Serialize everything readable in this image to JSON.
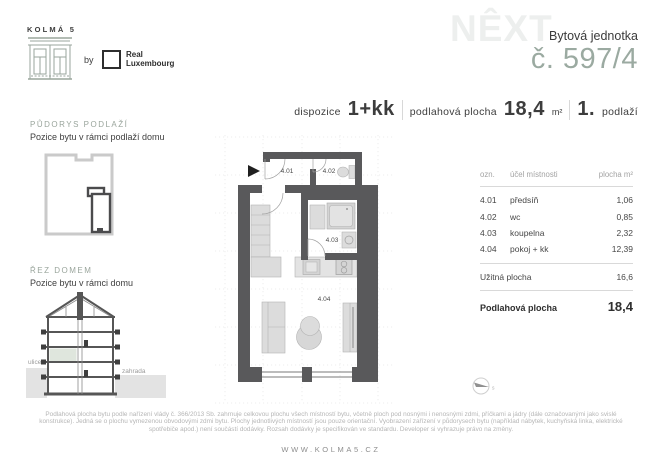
{
  "header": {
    "logo_title": "KOLMÁ 5",
    "by_label": "by",
    "partner_logo": "Real Luxembourg",
    "watermark": "NÊXT",
    "unit_label": "Bytová jednotka",
    "unit_number": "č. 597/4"
  },
  "summary": {
    "disposition_label": "dispozice",
    "disposition_value": "1+kk",
    "floor_area_label": "podlahová plocha",
    "floor_area_value": "18,4",
    "floor_area_unit": "m²",
    "storey_value": "1.",
    "storey_label": "podlaží"
  },
  "sidebar": {
    "plan_thumb": {
      "title": "PŮDORYS PODLAŽÍ",
      "subtitle": "Pozice bytu v rámci podlaží domu"
    },
    "section_thumb": {
      "title": "ŘEZ DOMEM",
      "subtitle": "Pozice bytu v rámci domu",
      "street_label": "ulice",
      "garden_label": "zahrada"
    }
  },
  "floorplan": {
    "room_labels": [
      "4.01",
      "4.02",
      "4.03",
      "4.04"
    ],
    "compass_label": "s"
  },
  "room_table": {
    "header": {
      "id": "ozn.",
      "purpose": "účel místnosti",
      "area": "plocha m²"
    },
    "rows": [
      {
        "id": "4.01",
        "purpose": "předsíň",
        "area": "1,06"
      },
      {
        "id": "4.02",
        "purpose": "wc",
        "area": "0,85"
      },
      {
        "id": "4.03",
        "purpose": "koupelna",
        "area": "2,32"
      },
      {
        "id": "4.04",
        "purpose": "pokoj + kk",
        "area": "12,39"
      }
    ],
    "usable_area_label": "Užitná plocha",
    "usable_area_value": "16,6",
    "floor_area_label": "Podlahová plocha",
    "floor_area_value": "18,4"
  },
  "footer": {
    "disclaimer": "Podlahová plocha bytu podle nařízení vlády č. 366/2013 Sb. zahrnuje celkovou plochu všech místností bytu, včetně ploch pod nosnými i nenosnými zdmi, příčkami a jádry (dále označovanými jako svislé konstrukce). Jedná se o plochu vymezenou obvodovými zdmi bytu. Plochy jednotlivých místností jsou pouze orientační. Vyobrazení zařízení v půdorysech bytu (například nábytek, kuchyňská linka, elektrické spotřebiče apod.) není součástí dodávky. Rozsah dodávky je specifikován ve standardu. Developer si vyhrazuje právo na změny.",
    "website": "WWW.KOLMA5.CZ"
  },
  "colors": {
    "wall": "#59595b",
    "furniture": "#dcdcdc",
    "accent_sage": "#9aa59c",
    "unit_number": "#9baaa1",
    "watermark": "#edefee",
    "text_dark": "#3d3d3d",
    "highlight_floor": "#dfe6dd"
  }
}
